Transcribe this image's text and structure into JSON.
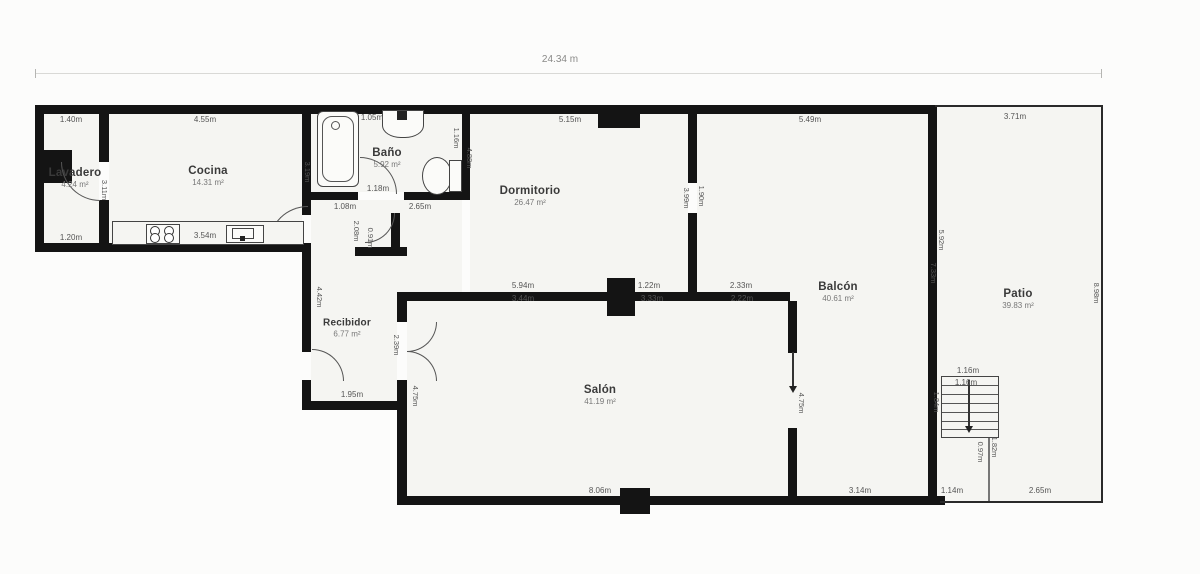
{
  "plan": {
    "total_width": "24.34 m",
    "colors": {
      "wall": "#141414",
      "floor": "#f5f5f2"
    },
    "rooms": [
      {
        "name": "Lavadero",
        "area": "4.24 m²"
      },
      {
        "name": "Cocina",
        "area": "14.31 m²"
      },
      {
        "name": "Baño",
        "area": "5.92 m²"
      },
      {
        "name": "Dormitorio",
        "area": "26.47 m²"
      },
      {
        "name": "Recibidor",
        "area": "6.77 m²"
      },
      {
        "name": "Salón",
        "area": "41.19 m²"
      },
      {
        "name": "Balcón",
        "area": "40.61 m²"
      },
      {
        "name": "Patio",
        "area": "39.83 m²"
      }
    ],
    "dims": [
      "1.40m",
      "4.55m",
      "1.05m",
      "5.15m",
      "5.49m",
      "3.71m",
      "1.20m",
      "3.54m",
      "1.08m",
      "2.65m",
      "1.18m",
      "5.94m",
      "1.22m",
      "2.33m",
      "3.44m",
      "3.33m",
      "2.22m",
      "1.95m",
      "8.06m",
      "3.14m",
      "1.14m",
      "2.65m",
      "1.16m",
      "1.16m"
    ],
    "vdims": [
      "3.11m",
      "3.19m",
      "1.16m",
      "4.88m",
      "2.08m",
      "0.91m",
      "4.42m",
      "2.39m",
      "4.75m",
      "4.75m",
      "3.99m",
      "1.90m",
      "5.92m",
      "7.33m",
      "8.98m",
      "1.84m",
      "1.82m",
      "0.97m"
    ]
  }
}
